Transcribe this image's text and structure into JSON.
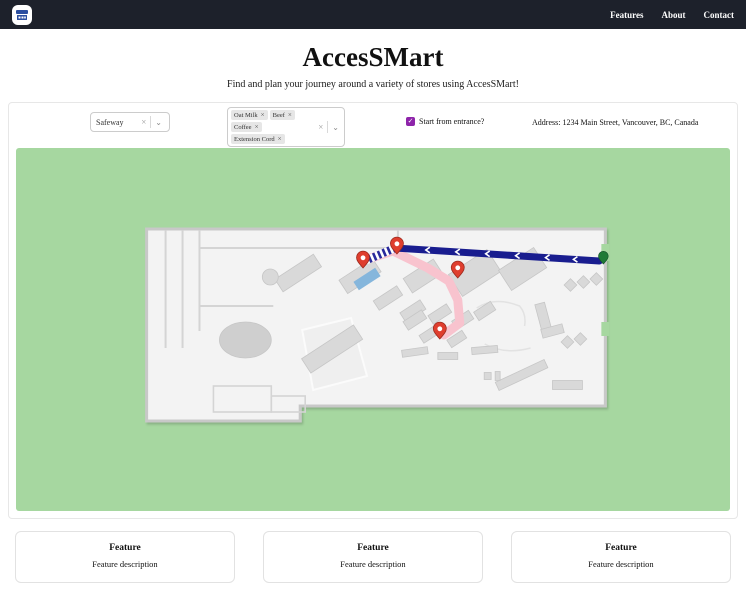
{
  "colors": {
    "navbar_bg": "#1d212b",
    "map_bg": "#a6d7a0",
    "route_primary": "#191d8f",
    "route_walked": "#f8c3ce",
    "pin_red": "#df3e2e",
    "entrance_green": "#1f7a36",
    "checkbox_purple": "#8e24aa",
    "shelf_highlight": "#85b6dc",
    "logo_blue": "#2b4ea0"
  },
  "navbar": {
    "logo_icon": "storefront-icon",
    "links": [
      {
        "label": "Features"
      },
      {
        "label": "About"
      },
      {
        "label": "Contact"
      }
    ]
  },
  "hero": {
    "title": "AccesSMart",
    "subtitle": "Find and plan your journey around a variety of stores using AccesSMart!"
  },
  "toolbar": {
    "store_select": {
      "value": "Safeway",
      "clear_icon": "×",
      "dropdown_icon": "⌄"
    },
    "items_select": {
      "tags": [
        {
          "label": "Oat Milk",
          "remove_icon": "×"
        },
        {
          "label": "Beef",
          "remove_icon": "×"
        },
        {
          "label": "Coffee",
          "remove_icon": "×"
        },
        {
          "label": "Extension Cord",
          "remove_icon": "×"
        }
      ],
      "clear_icon": "×",
      "dropdown_icon": "⌄"
    },
    "entrance_checkbox": {
      "label": "Start from entrance?",
      "checked": true,
      "check_glyph": "✓"
    },
    "address": "Address: 1234 Main Street, Vancouver, BC, Canada"
  },
  "map": {
    "kind": "store-floor-plan",
    "destination_pin_count": 4,
    "has_entrance_marker": true,
    "routes": [
      {
        "name": "planned-route",
        "style": "solid navy with white direction arrows"
      },
      {
        "name": "alternate-route",
        "style": "pink walked path"
      }
    ]
  },
  "features": [
    {
      "title": "Feature",
      "description": "Feature description"
    },
    {
      "title": "Feature",
      "description": "Feature description"
    },
    {
      "title": "Feature",
      "description": "Feature description"
    }
  ]
}
